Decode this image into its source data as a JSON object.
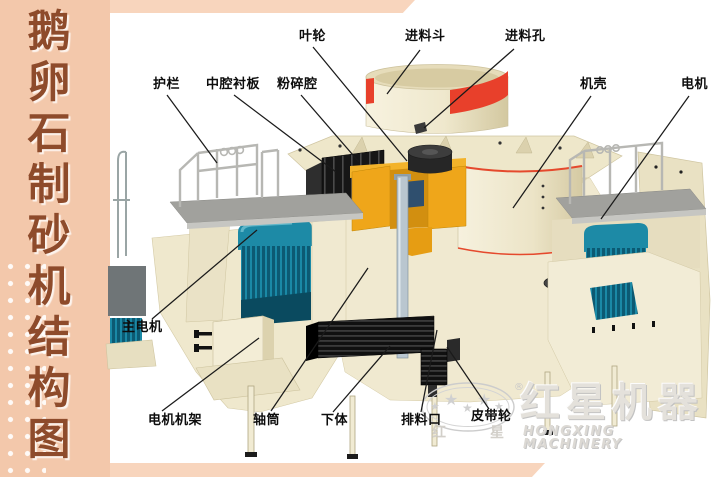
{
  "sidebar": {
    "title": "鹅卵石制砂机结构图"
  },
  "diagram_labels": {
    "impeller": "叶轮",
    "feed_hopper": "进料斗",
    "feed_hole": "进料孔",
    "guard_rail": "护栏",
    "middle_chamber_liner": "中腔衬板",
    "crushing_chamber": "粉碎腔",
    "machine_casing": "机壳",
    "motor": "电机",
    "main_motor": "主电机",
    "motor_frame": "电机机架",
    "shaft_tube": "轴筒",
    "lower_body": "下体",
    "discharge_port": "排料口",
    "belt_pulley": "皮带轮"
  },
  "watermark": {
    "brand_cn": "红星机器",
    "brand_en": "HONGXING MACHINERY",
    "seal_left": "红",
    "seal_right": "星",
    "registered": "®",
    "star": "★"
  },
  "colors": {
    "sidebar_pink": "#f3c8ab",
    "ribbon_pink": "#f8d5bd",
    "sidebar_text_brown": "#8e4b2b",
    "machine_cream": "#f1ebd3",
    "hopper_red_band": "#e8402b",
    "motor_teal": "#1d8aa6",
    "chamber_yellow": "#efa61a",
    "platform_gray": "#a1a19d",
    "label_black": "#0d0d0d"
  }
}
